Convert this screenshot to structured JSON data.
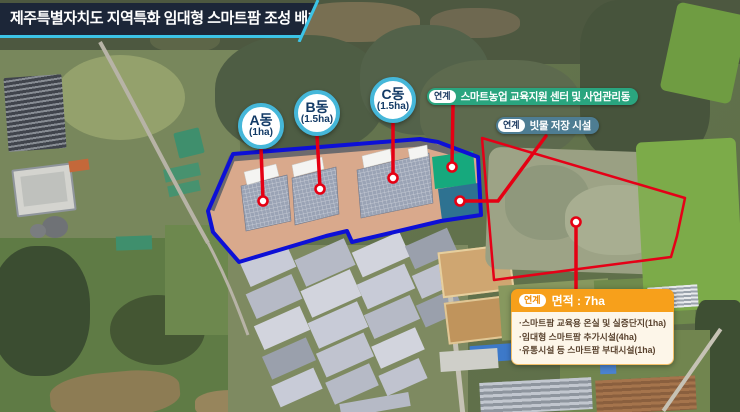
{
  "title_bar": {
    "text": "제주특별자치도 지역특화 임대형 스마트팜 조성 배치도"
  },
  "greenhouses": [
    {
      "label": "A동",
      "area": "(1ha)"
    },
    {
      "label": "B동",
      "area": "(1.5ha)"
    },
    {
      "label": "C동",
      "area": "(1.5ha)"
    }
  ],
  "linked_facilities": [
    {
      "badge": "연계",
      "label": "스마트농업 교육지원 센터 및 사업관리동"
    },
    {
      "badge": "연계",
      "label": "빗물 저장 시설"
    }
  ],
  "linked_area_box": {
    "badge": "연계",
    "title": "면적 : 7ha",
    "items": [
      "·스마트팜 교육용 온실 및 실증단지(1ha)",
      "·임대형 스마트팜 추가시설(4ha)",
      "·유통시설 등 스마트팜 부대시설(1ha)"
    ]
  },
  "colors": {
    "accent_cyan": "#3cc3e6",
    "title_bg": "#1c2638",
    "circle_border": "#45b7d9",
    "text_navy": "#123a66",
    "pill_green": "#2aa57f",
    "pill_slate": "#4e7d93",
    "orange": "#f7a01b",
    "connector_red": "#e50013",
    "site_outline_blue": "#0d10d6",
    "linked_outline_red": "#e50017",
    "site_ground_tan": "#d9a98c",
    "reservoir_green": "#16a97d",
    "reservoir_teal": "#2e7291"
  }
}
